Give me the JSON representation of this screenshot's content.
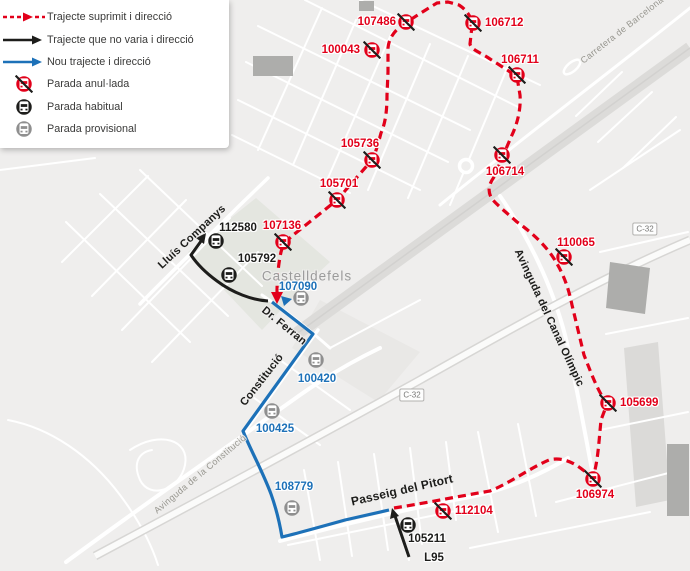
{
  "legend": {
    "items": [
      {
        "key": "route-removed",
        "label": "Trajecte suprimit i direcció"
      },
      {
        "key": "route-unchanged",
        "label": "Trajecte que no varia i direcció"
      },
      {
        "key": "route-new",
        "label": "Nou trajecte i direcció"
      },
      {
        "key": "stop-cancelled",
        "label": "Parada anul·lada"
      },
      {
        "key": "stop-regular",
        "label": "Parada habitual"
      },
      {
        "key": "stop-provisional",
        "label": "Parada provisional"
      }
    ]
  },
  "colors": {
    "removed": "#e2001a",
    "unchanged": "#1d1d1b",
    "new": "#1d71b8",
    "cancelled": "#e2001a",
    "regular": "#1d1d1b",
    "provisional": "#8f8f8f"
  },
  "map": {
    "place_labels": [
      {
        "text": "Castelldefels",
        "x": 307,
        "y": 276,
        "rotate": 0,
        "size": 13.5,
        "color": "#9b9b9b",
        "weight": 400,
        "spacing": 1
      }
    ],
    "street_labels": [
      {
        "text": "Lluís Companys",
        "x": 192,
        "y": 237,
        "rotate": -43,
        "size": 11,
        "color": "#1d1d1b",
        "weight": 700,
        "spacing": 0.2
      },
      {
        "text": "Dr. Ferran",
        "x": 284,
        "y": 326,
        "rotate": 39,
        "size": 11,
        "color": "#1d1d1b",
        "weight": 700,
        "spacing": 0.2
      },
      {
        "text": "Constitució",
        "x": 262,
        "y": 380,
        "rotate": -52,
        "size": 11,
        "color": "#1d1d1b",
        "weight": 700,
        "spacing": 0.2
      },
      {
        "text": "Avinguda de la Constitució",
        "x": 200,
        "y": 474,
        "rotate": -40,
        "size": 9,
        "color": "#97968f",
        "weight": 400,
        "spacing": 0.4
      },
      {
        "text": "Passeig del Pitort",
        "x": 402,
        "y": 490,
        "rotate": -13,
        "size": 12,
        "color": "#1d1d1b",
        "weight": 700,
        "spacing": 0.2
      },
      {
        "text": "Avinguda del Canal Olímpic",
        "x": 549,
        "y": 318,
        "rotate": 65,
        "size": 11,
        "color": "#1d1d1b",
        "weight": 700,
        "spacing": 0.2
      },
      {
        "text": "Carretera de Barcelona",
        "x": 622,
        "y": 30,
        "rotate": -38,
        "size": 9,
        "color": "#97968f",
        "weight": 400,
        "spacing": 0.4
      }
    ],
    "road_shields": [
      {
        "text": "C-32",
        "x": 412,
        "y": 395
      },
      {
        "text": "C-32",
        "x": 645,
        "y": 229
      }
    ],
    "stops": [
      {
        "id": "107486",
        "type": "cancelled",
        "x": 406,
        "y": 22,
        "lx": 396,
        "ly": 22,
        "align": "right"
      },
      {
        "id": "106712",
        "type": "cancelled",
        "x": 473,
        "y": 23,
        "lx": 485,
        "ly": 23,
        "align": "left"
      },
      {
        "id": "100043",
        "type": "cancelled",
        "x": 372,
        "y": 50,
        "lx": 360,
        "ly": 50,
        "align": "right"
      },
      {
        "id": "106711",
        "type": "cancelled",
        "x": 517,
        "y": 75,
        "lx": 520,
        "ly": 60,
        "align": "center"
      },
      {
        "id": "105736",
        "type": "cancelled",
        "x": 372,
        "y": 160,
        "lx": 360,
        "ly": 144,
        "align": "center"
      },
      {
        "id": "105701",
        "type": "cancelled",
        "x": 337,
        "y": 200,
        "lx": 339,
        "ly": 184,
        "align": "center"
      },
      {
        "id": "106714",
        "type": "cancelled",
        "x": 502,
        "y": 155,
        "lx": 505,
        "ly": 172,
        "align": "center"
      },
      {
        "id": "107136",
        "type": "cancelled",
        "x": 283,
        "y": 242,
        "lx": 282,
        "ly": 226,
        "align": "center"
      },
      {
        "id": "110065",
        "type": "cancelled",
        "x": 564,
        "y": 257,
        "lx": 576,
        "ly": 243,
        "align": "center"
      },
      {
        "id": "105699",
        "type": "cancelled",
        "x": 608,
        "y": 403,
        "lx": 620,
        "ly": 403,
        "align": "left"
      },
      {
        "id": "106974",
        "type": "cancelled",
        "x": 593,
        "y": 479,
        "lx": 595,
        "ly": 495,
        "align": "center"
      },
      {
        "id": "112104",
        "type": "cancelled",
        "x": 443,
        "y": 511,
        "lx": 455,
        "ly": 511,
        "align": "left"
      },
      {
        "id": "112580",
        "type": "regular",
        "x": 216,
        "y": 241,
        "lx": 238,
        "ly": 228,
        "align": "center"
      },
      {
        "id": "105792",
        "type": "regular",
        "x": 229,
        "y": 275,
        "lx": 257,
        "ly": 259,
        "align": "center"
      },
      {
        "id": "105211",
        "type": "regular",
        "x": 408,
        "y": 525,
        "lx": 427,
        "ly": 539,
        "align": "center"
      },
      {
        "id": "107090",
        "type": "provisional",
        "x": 301,
        "y": 298,
        "lx": 298,
        "ly": 287,
        "align": "center"
      },
      {
        "id": "100420",
        "type": "provisional",
        "x": 316,
        "y": 360,
        "lx": 317,
        "ly": 379,
        "align": "center"
      },
      {
        "id": "100425",
        "type": "provisional",
        "x": 272,
        "y": 411,
        "lx": 275,
        "ly": 429,
        "align": "center"
      },
      {
        "id": "108779",
        "type": "provisional",
        "x": 292,
        "y": 508,
        "lx": 294,
        "ly": 487,
        "align": "center"
      }
    ],
    "extra_labels": [
      {
        "text": "L95",
        "x": 434,
        "y": 558,
        "size": 11.5,
        "weight": 700,
        "color": "#1d1d1b"
      }
    ]
  }
}
